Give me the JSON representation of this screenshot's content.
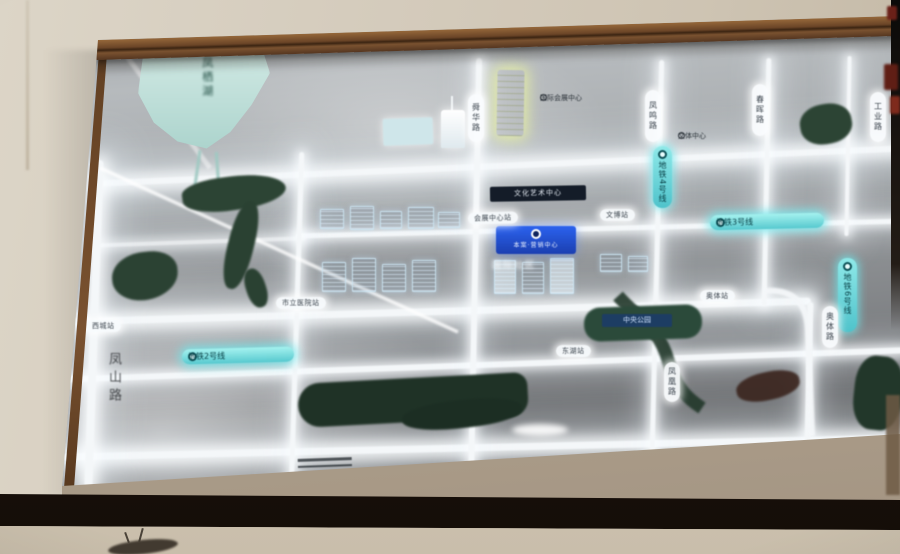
{
  "display": {
    "lake_label": "凤栖湖",
    "mountain_road_label": "凤山路",
    "project_badge": {
      "name": "本案·营销中心"
    },
    "reflection_label": "国际社区",
    "plaques": {
      "dark": "文化艺术中心",
      "park": "中央公园"
    },
    "poi_labels": [
      "国际会展中心",
      "文体中心",
      "湿地公园"
    ],
    "metro": {
      "line3": "地铁3号线",
      "line2": "地铁2号线",
      "line4": "地铁4号线",
      "line6": "地铁6号线"
    },
    "road_labels": [
      "舜华路",
      "凤鸣路",
      "春晖路",
      "工业路",
      "奥体路",
      "凤凰路"
    ],
    "stations": [
      "会展中心站",
      "文博站",
      "市立医院站",
      "西城站",
      "奥体站",
      "东湖站"
    ],
    "colors": {
      "road_glow": "#f4f7f9",
      "metro_pill": "#57c9cf",
      "badge_blue": "#2458e8",
      "lake": "#bfe0da",
      "park_green": "#2b4233",
      "highlight_yellow": "#e9f2a2",
      "wood_trim": "#6b4527",
      "wall": "#d3cabb"
    }
  }
}
